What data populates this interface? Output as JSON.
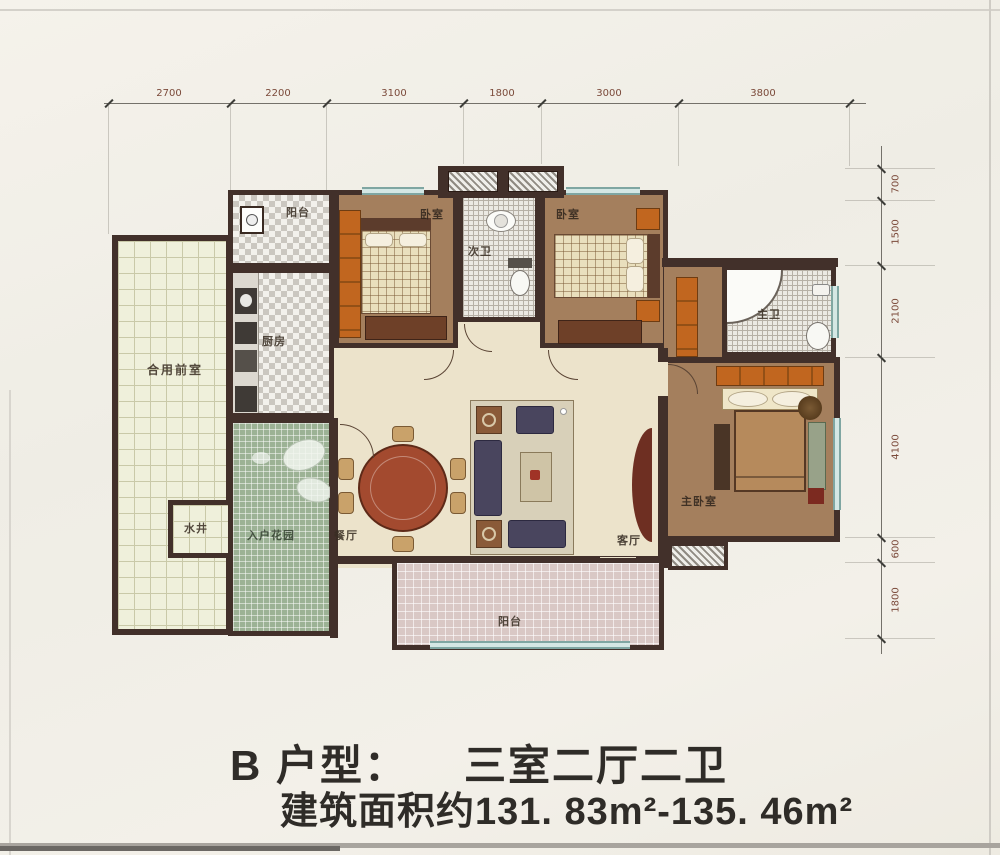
{
  "palette": {
    "wall": "#42302a",
    "floor_bedroom": "#a47f5d",
    "floor_living": "#ece3cb",
    "garden_green": "#9cb295",
    "front_room_tile": "#eff0db",
    "balcony_pink": "#d9c8c5",
    "window_blue": "#a9cdc9",
    "furniture_orange": "#c1661f",
    "sofa_navy": "#49455e",
    "table_red": "#a34a2f",
    "dimension_text": "#7b4a3a",
    "caption_text": "#2f2c28"
  },
  "dimensions": {
    "top": [
      "2700",
      "2200",
      "3100",
      "1800",
      "3000",
      "3800"
    ],
    "right": [
      "700",
      "1500",
      "2100",
      "4100",
      "600",
      "1800"
    ]
  },
  "rooms": {
    "balcony_top": "阳台",
    "bedroom_left": "卧室",
    "bath_secondary": "次卫",
    "bedroom_right": "卧室",
    "bath_master": "主卫",
    "shared_front_room": "合用前室",
    "kitchen": "厨房",
    "water_well": "水井",
    "entry_garden": "入户花园",
    "dining": "餐厅",
    "living": "客厅",
    "bedroom_master": "主卧室",
    "balcony_bottom": "阳台"
  },
  "caption": {
    "unit_label": "B 户型：",
    "unit_value": "三室二厅二卫",
    "area_text": "建筑面积约131. 83m²-135. 46m²"
  }
}
